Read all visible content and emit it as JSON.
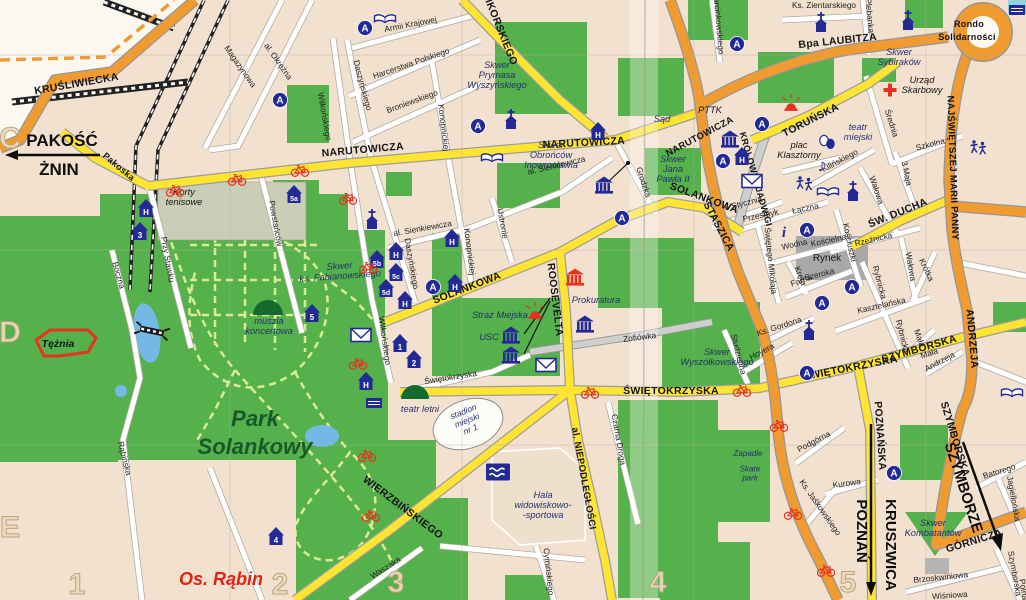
{
  "colors": {
    "background": "#f3e1d0",
    "unmapped": "#fbf9ef",
    "park_green": "#54b14b",
    "dark_green": "#156b2f",
    "road_yellow": "#ffe431",
    "road_orange": "#ef9b30",
    "road_white": "#ffffff",
    "water_blue": "#74b9e6",
    "icon_blue": "#232a96",
    "icon_red": "#e8321e",
    "rynek_gray": "#a8a8a8"
  },
  "grid": {
    "row_labels": [
      {
        "text": "C",
        "x": 10,
        "y": 148
      },
      {
        "text": "D",
        "x": 10,
        "y": 342
      },
      {
        "text": "E",
        "x": 10,
        "y": 537
      }
    ],
    "col_labels": [
      {
        "text": "1",
        "x": 77,
        "y": 594
      },
      {
        "text": "2",
        "x": 280,
        "y": 594
      },
      {
        "text": "3",
        "x": 396,
        "y": 592
      },
      {
        "text": "4",
        "x": 658,
        "y": 592
      },
      {
        "text": "5",
        "x": 848,
        "y": 592
      }
    ]
  },
  "destinations": [
    {
      "lines": [
        "PAKOŚĆ"
      ],
      "x": 62,
      "y": 146,
      "size": 17
    },
    {
      "lines": [
        "ŻNIN"
      ],
      "x": 59,
      "y": 175,
      "size": 17
    },
    {
      "lines": [
        "POZNAŃ"
      ],
      "x": 857,
      "y": 531,
      "rot": 90,
      "size": 15
    },
    {
      "lines": [
        "KRUSZWICA"
      ],
      "x": 886,
      "y": 545,
      "rot": 90,
      "size": 15
    },
    {
      "lines": [
        "SZYMBORZE"
      ],
      "x": 959,
      "y": 489,
      "rot": 72,
      "size": 15
    }
  ],
  "road_labels": [
    {
      "text": "KRUŚLIWIECKA",
      "x": 77,
      "y": 87,
      "rot": -10
    },
    {
      "text": "Bpa LAUBITZA",
      "x": 838,
      "y": 44,
      "rot": -6
    },
    {
      "text": "Rondo",
      "x": 969,
      "y": 27,
      "size": 9
    },
    {
      "text": "Solidarności",
      "x": 967,
      "y": 40,
      "size": 9
    },
    {
      "text": "NAJŚWIĘTSZEJ MARII PANNY",
      "x": 950,
      "y": 168,
      "rot": 88,
      "size": 9.5
    },
    {
      "text": "STASZICA",
      "x": 716,
      "y": 228,
      "rot": 62
    },
    {
      "text": "ANDRZEJA",
      "x": 969,
      "y": 339,
      "rot": 85
    },
    {
      "text": "SZYMBORSKA",
      "x": 952,
      "y": 440,
      "rot": 73
    },
    {
      "text": "GÓRNICZA",
      "x": 975,
      "y": 544,
      "rot": -17
    },
    {
      "text": "KRÓLOWEJ JADWIGI",
      "x": 753,
      "y": 180,
      "rot": 74,
      "size": 9
    },
    {
      "text": "NARUTOWICZA",
      "x": 363,
      "y": 153,
      "rot": -5
    },
    {
      "text": "NARUTOWICZA",
      "x": 584,
      "y": 146,
      "rot": -3
    },
    {
      "text": "NARUTOWICZA",
      "x": 701,
      "y": 139,
      "rot": -28,
      "size": 9.5
    },
    {
      "text": "SIKORSKIEGO",
      "x": 497,
      "y": 30,
      "rot": 68
    },
    {
      "text": "SOLANKOWA",
      "x": 468,
      "y": 291,
      "rot": -21
    },
    {
      "text": "SOLANKOWA",
      "x": 703,
      "y": 201,
      "rot": 20
    },
    {
      "text": "ROOSEVELTA",
      "x": 552,
      "y": 300,
      "rot": 83
    },
    {
      "text": "al. NIEPODLEGŁOŚCI",
      "x": 581,
      "y": 479,
      "rot": 80,
      "size": 9.5
    },
    {
      "text": "ŚWIĘTOKRZYSKA",
      "x": 671,
      "y": 394,
      "rot": 0
    },
    {
      "text": "ŚWIĘTOKRZYSKA",
      "x": 851,
      "y": 371,
      "rot": -11
    },
    {
      "text": "SZYMBORSKA",
      "x": 920,
      "y": 352,
      "rot": -16
    },
    {
      "text": "ŚW. DUCHA",
      "x": 899,
      "y": 216,
      "rot": -22
    },
    {
      "text": "TORUŃSKA",
      "x": 812,
      "y": 123,
      "rot": -27
    },
    {
      "text": "WIERZBIŃSKIEGO",
      "x": 401,
      "y": 510,
      "rot": 37
    },
    {
      "text": "POZNAŃSKA",
      "x": 877,
      "y": 436,
      "rot": 86
    },
    {
      "text": "Pakoska",
      "x": 117,
      "y": 169,
      "rot": 40,
      "size": 9
    }
  ],
  "street_labels": [
    {
      "text": "Magazynowa",
      "x": 238,
      "y": 68,
      "rot": 55
    },
    {
      "text": "al. Okrężna",
      "x": 276,
      "y": 63,
      "rot": 55
    },
    {
      "text": "Wilkońskiego",
      "x": 322,
      "y": 117,
      "rot": 80
    },
    {
      "text": "Wilkońskiego",
      "x": 382,
      "y": 341,
      "rot": 82
    },
    {
      "text": "Armii Krajowej",
      "x": 411,
      "y": 27,
      "rot": -11
    },
    {
      "text": "Harcerstwa Polskiego",
      "x": 412,
      "y": 66,
      "rot": -19
    },
    {
      "text": "Broniewskiego",
      "x": 413,
      "y": 104,
      "rot": -20
    },
    {
      "text": "Daszyńskiego",
      "x": 360,
      "y": 86,
      "rot": 75
    },
    {
      "text": "Daszyńskiego",
      "x": 409,
      "y": 264,
      "rot": 80
    },
    {
      "text": "Konopnickiej",
      "x": 441,
      "y": 128,
      "rot": 83
    },
    {
      "text": "Konopnickiej",
      "x": 467,
      "y": 252,
      "rot": 83
    },
    {
      "text": "Ks. Zientarskiego",
      "x": 824,
      "y": 8,
      "rot": 0
    },
    {
      "text": "Plebanka",
      "x": 867,
      "y": 16,
      "rot": 85
    },
    {
      "text": "Marcinkowskiego",
      "x": 716,
      "y": 23,
      "rot": 85
    },
    {
      "text": "Średnia",
      "x": 889,
      "y": 124,
      "rot": 72
    },
    {
      "text": "Szkolna",
      "x": 931,
      "y": 147,
      "rot": -14
    },
    {
      "text": "3 Maja",
      "x": 904,
      "y": 174,
      "rot": 78
    },
    {
      "text": "Kilińskiego",
      "x": 841,
      "y": 163,
      "rot": -28
    },
    {
      "text": "Wałowa",
      "x": 874,
      "y": 191,
      "rot": 72
    },
    {
      "text": "Wałowa",
      "x": 908,
      "y": 267,
      "rot": 80
    },
    {
      "text": "Krótka",
      "x": 924,
      "y": 271,
      "rot": 65
    },
    {
      "text": "Rzeźnicka",
      "x": 874,
      "y": 242,
      "rot": -13
    },
    {
      "text": "Kościelna",
      "x": 829,
      "y": 243,
      "rot": -12
    },
    {
      "text": "Wodna",
      "x": 795,
      "y": 247,
      "rot": -12
    },
    {
      "text": "Kościuszki",
      "x": 847,
      "y": 243,
      "rot": 78
    },
    {
      "text": "Szeroka",
      "x": 820,
      "y": 277,
      "rot": -14
    },
    {
      "text": "Farna",
      "x": 802,
      "y": 283,
      "rot": -20
    },
    {
      "text": "Rybnicka",
      "x": 877,
      "y": 283,
      "rot": 75
    },
    {
      "text": "Rybnicka",
      "x": 900,
      "y": 337,
      "rot": 75
    },
    {
      "text": "Świętego Mikołaja",
      "x": 768,
      "y": 261,
      "rot": 84
    },
    {
      "text": "Kręta",
      "x": 798,
      "y": 277,
      "rot": 68
    },
    {
      "text": "Przesmyk",
      "x": 761,
      "y": 218,
      "rot": -12
    },
    {
      "text": "Łączna",
      "x": 806,
      "y": 211,
      "rot": -12
    },
    {
      "text": "6 Stycznia",
      "x": 744,
      "y": 206,
      "rot": -14
    },
    {
      "text": "Kasztelańska",
      "x": 882,
      "y": 308,
      "rot": -13
    },
    {
      "text": "Mała",
      "x": 917,
      "y": 339,
      "rot": 70
    },
    {
      "text": "Mała",
      "x": 930,
      "y": 356,
      "rot": -18
    },
    {
      "text": "Andrzeja",
      "x": 941,
      "y": 364,
      "rot": -28
    },
    {
      "text": "Ks. Gordona",
      "x": 780,
      "y": 329,
      "rot": -18
    },
    {
      "text": "Hoyera",
      "x": 763,
      "y": 354,
      "rot": -28
    },
    {
      "text": "Studzienna",
      "x": 736,
      "y": 355,
      "rot": 76
    },
    {
      "text": "Zofiówka",
      "x": 640,
      "y": 340,
      "rot": -7
    },
    {
      "text": "Podgórna",
      "x": 815,
      "y": 444,
      "rot": -28
    },
    {
      "text": "Kurowa",
      "x": 847,
      "y": 486,
      "rot": -8
    },
    {
      "text": "Ks. Jaśkowskiego",
      "x": 818,
      "y": 509,
      "rot": 55
    },
    {
      "text": "Batorego",
      "x": 1000,
      "y": 474,
      "rot": -17
    },
    {
      "text": "Jagiellońska",
      "x": 1011,
      "y": 499,
      "rot": 80
    },
    {
      "text": "Szymborska",
      "x": 1012,
      "y": 574,
      "rot": 80
    },
    {
      "text": "Polna",
      "x": 1021,
      "y": 590,
      "rot": 80
    },
    {
      "text": "Brzoskwiniowa",
      "x": 941,
      "y": 580,
      "rot": -6
    },
    {
      "text": "Wiśniowa",
      "x": 950,
      "y": 598,
      "rot": -4
    },
    {
      "text": "Czarna Droga",
      "x": 616,
      "y": 440,
      "rot": 80
    },
    {
      "text": "Cymińskiego",
      "x": 546,
      "y": 572,
      "rot": 84
    },
    {
      "text": "Waszaka",
      "x": 387,
      "y": 570,
      "rot": -33
    },
    {
      "text": "Rąbińska",
      "x": 122,
      "y": 459,
      "rot": 76
    },
    {
      "text": "Boczna",
      "x": 116,
      "y": 276,
      "rot": 74
    },
    {
      "text": "Przy Stawku",
      "x": 165,
      "y": 260,
      "rot": 80
    },
    {
      "text": "Powstańców",
      "x": 273,
      "y": 224,
      "rot": 80
    },
    {
      "text": "Ustronie",
      "x": 500,
      "y": 224,
      "rot": 80
    },
    {
      "text": "al. Sienkiewicza",
      "x": 557,
      "y": 168,
      "rot": -13
    },
    {
      "text": "al. Sienkiewicza",
      "x": 423,
      "y": 231,
      "rot": -10
    },
    {
      "text": "Grodzka",
      "x": 641,
      "y": 183,
      "rot": 72
    },
    {
      "text": "Świętokrzyska",
      "x": 451,
      "y": 380,
      "rot": -9
    }
  ],
  "place_labels": [
    {
      "lines": [
        "Skwer",
        "Prymasa",
        "Wyszyńskiego"
      ],
      "x": 497,
      "y": 78
    },
    {
      "lines": [
        "Sąd"
      ],
      "x": 662,
      "y": 122
    },
    {
      "lines": [
        "Skwer",
        "Obrońców",
        "Inowrocławia"
      ],
      "x": 551,
      "y": 158
    },
    {
      "lines": [
        "Skwer",
        "Jana",
        "Pawła II"
      ],
      "x": 673,
      "y": 172
    },
    {
      "lines": [
        "Skwer",
        "Sybiraków"
      ],
      "x": 899,
      "y": 60
    },
    {
      "lines": [
        "Urząd",
        "Skarbowy"
      ],
      "x": 922,
      "y": 88,
      "cls": "lbl-place-black"
    },
    {
      "lines": [
        "PTTK"
      ],
      "x": 710,
      "y": 113,
      "cls": "lbl-place-black"
    },
    {
      "lines": [
        "teatr",
        "miejski"
      ],
      "x": 858,
      "y": 135
    },
    {
      "lines": [
        "plac",
        "Klasztorny"
      ],
      "x": 799,
      "y": 153,
      "cls": "lbl-place-black"
    },
    {
      "lines": [
        "Rynek"
      ],
      "x": 827,
      "y": 261,
      "cls": "lbl-rynek"
    },
    {
      "lines": [
        "Korty",
        "tenisowe"
      ],
      "x": 184,
      "y": 200,
      "cls": "lbl-place-black"
    },
    {
      "lines": [
        "Skwer",
        "ks. Fabianowskiego"
      ],
      "x": 340,
      "y": 274,
      "rot": -4
    },
    {
      "lines": [
        "muszla",
        "koncertowa"
      ],
      "x": 269,
      "y": 329
    },
    {
      "lines": [
        "Tężnia"
      ],
      "x": 58,
      "y": 347,
      "cls": "lbl-place-bold-black"
    },
    {
      "lines": [
        "Park",
        "Solankowy"
      ],
      "x": 255,
      "y": 440,
      "cls": "lbl-park",
      "lh": 28
    },
    {
      "lines": [
        "Os. Rąbin"
      ],
      "x": 221,
      "y": 585,
      "cls": "lbl-district"
    },
    {
      "lines": [
        "teatr letni"
      ],
      "x": 420,
      "y": 412
    },
    {
      "lines": [
        "stadion",
        "miejski",
        "nr 1"
      ],
      "x": 468,
      "y": 423,
      "rot": -22,
      "size": 8.5
    },
    {
      "lines": [
        "Hala",
        "widowiskowo-",
        "-sportowa"
      ],
      "x": 543,
      "y": 508
    },
    {
      "lines": [
        "Straż Miejska"
      ],
      "x": 500,
      "y": 318
    },
    {
      "lines": [
        "USC"
      ],
      "x": 489,
      "y": 340
    },
    {
      "lines": [
        "Prokuratura"
      ],
      "x": 596,
      "y": 303
    },
    {
      "lines": [
        "Skwer",
        "Wyszółkowskiego"
      ],
      "x": 717,
      "y": 360
    },
    {
      "lines": [
        "Skwer",
        "Kombatantów"
      ],
      "x": 933,
      "y": 531
    },
    {
      "lines": [
        "Zapadle"
      ],
      "x": 748,
      "y": 456,
      "size": 8
    },
    {
      "lines": [
        "Skate",
        "park"
      ],
      "x": 750,
      "y": 476,
      "size": 8,
      "lh": 9
    }
  ],
  "icons": [
    {
      "type": "bus-stop",
      "x": 280,
      "y": 100,
      "label": "A"
    },
    {
      "type": "bus-stop",
      "x": 365,
      "y": 28,
      "label": "A"
    },
    {
      "type": "bus-stop",
      "x": 478,
      "y": 126,
      "label": "A"
    },
    {
      "type": "bus-stop",
      "x": 737,
      "y": 44,
      "label": "A"
    },
    {
      "type": "bus-stop",
      "x": 762,
      "y": 124,
      "label": "A"
    },
    {
      "type": "bus-stop",
      "x": 723,
      "y": 161,
      "label": "A"
    },
    {
      "type": "bus-stop",
      "x": 622,
      "y": 218,
      "label": "A"
    },
    {
      "type": "bus-stop",
      "x": 433,
      "y": 287,
      "label": "A"
    },
    {
      "type": "bus-stop",
      "x": 807,
      "y": 230,
      "label": "A"
    },
    {
      "type": "bus-stop",
      "x": 852,
      "y": 287,
      "label": "A"
    },
    {
      "type": "bus-stop",
      "x": 822,
      "y": 303,
      "label": "A"
    },
    {
      "type": "bus-stop",
      "x": 807,
      "y": 373,
      "label": "A"
    },
    {
      "type": "bus-stop",
      "x": 894,
      "y": 473,
      "label": "A"
    },
    {
      "type": "house",
      "x": 146,
      "y": 208,
      "label": "H"
    },
    {
      "type": "house",
      "x": 598,
      "y": 131,
      "label": "H"
    },
    {
      "type": "house",
      "x": 742,
      "y": 156,
      "label": "H"
    },
    {
      "type": "house",
      "x": 396,
      "y": 251,
      "label": "H"
    },
    {
      "type": "house",
      "x": 452,
      "y": 238,
      "label": "H"
    },
    {
      "type": "house",
      "x": 455,
      "y": 283,
      "label": "H"
    },
    {
      "type": "house",
      "x": 405,
      "y": 300,
      "label": "H"
    },
    {
      "type": "house",
      "x": 366,
      "y": 381,
      "label": "H"
    },
    {
      "type": "house",
      "x": 140,
      "y": 231,
      "label": "3"
    },
    {
      "type": "house",
      "x": 294,
      "y": 194,
      "label": "5a"
    },
    {
      "type": "house",
      "x": 377,
      "y": 259,
      "label": "5b"
    },
    {
      "type": "house",
      "x": 396,
      "y": 272,
      "label": "5c"
    },
    {
      "type": "house",
      "x": 386,
      "y": 288,
      "label": "5d"
    },
    {
      "type": "house",
      "x": 312,
      "y": 313,
      "label": "5"
    },
    {
      "type": "house",
      "x": 400,
      "y": 343,
      "label": "1"
    },
    {
      "type": "house",
      "x": 414,
      "y": 359,
      "label": "2"
    },
    {
      "type": "house",
      "x": 276,
      "y": 536,
      "label": "4"
    },
    {
      "type": "church",
      "x": 511,
      "y": 122
    },
    {
      "type": "church",
      "x": 372,
      "y": 222
    },
    {
      "type": "church",
      "x": 853,
      "y": 194
    },
    {
      "type": "church",
      "x": 821,
      "y": 25
    },
    {
      "type": "church",
      "x": 908,
      "y": 23
    },
    {
      "type": "church",
      "x": 809,
      "y": 333
    },
    {
      "type": "book",
      "x": 385,
      "y": 19
    },
    {
      "type": "book",
      "x": 492,
      "y": 158
    },
    {
      "type": "book",
      "x": 828,
      "y": 192
    },
    {
      "type": "book",
      "x": 1012,
      "y": 393
    },
    {
      "type": "envelope",
      "x": 361,
      "y": 335
    },
    {
      "type": "envelope",
      "x": 546,
      "y": 365
    },
    {
      "type": "envelope",
      "x": 752,
      "y": 181
    },
    {
      "type": "museum",
      "x": 730,
      "y": 140
    },
    {
      "type": "museum",
      "x": 604,
      "y": 186
    },
    {
      "type": "museum",
      "x": 511,
      "y": 336
    },
    {
      "type": "museum",
      "x": 511,
      "y": 356
    },
    {
      "type": "museum",
      "x": 585,
      "y": 325
    },
    {
      "type": "museum-red",
      "x": 575,
      "y": 278
    },
    {
      "type": "siren",
      "x": 535,
      "y": 313
    },
    {
      "type": "siren",
      "x": 791,
      "y": 105
    },
    {
      "type": "red-cross",
      "x": 890,
      "y": 90
    },
    {
      "type": "swimming",
      "x": 498,
      "y": 472
    },
    {
      "type": "theater-masks",
      "x": 827,
      "y": 142
    },
    {
      "type": "building",
      "x": 374,
      "y": 403
    },
    {
      "type": "building",
      "x": 1017,
      "y": 10
    },
    {
      "type": "music-note",
      "x": 822,
      "y": 166
    },
    {
      "type": "info",
      "x": 784,
      "y": 232
    },
    {
      "type": "dancers",
      "x": 804,
      "y": 184
    },
    {
      "type": "dancers",
      "x": 978,
      "y": 148
    },
    {
      "type": "bridge",
      "x": 152,
      "y": 331,
      "rot": 12
    },
    {
      "type": "bicycle",
      "x": 175,
      "y": 190
    },
    {
      "type": "bicycle",
      "x": 237,
      "y": 179
    },
    {
      "type": "bicycle",
      "x": 300,
      "y": 170
    },
    {
      "type": "bicycle",
      "x": 348,
      "y": 198
    },
    {
      "type": "bicycle",
      "x": 368,
      "y": 267
    },
    {
      "type": "bicycle",
      "x": 358,
      "y": 363
    },
    {
      "type": "bicycle",
      "x": 367,
      "y": 455
    },
    {
      "type": "bicycle",
      "x": 371,
      "y": 515
    },
    {
      "type": "bicycle",
      "x": 590,
      "y": 392
    },
    {
      "type": "bicycle",
      "x": 742,
      "y": 390
    },
    {
      "type": "bicycle",
      "x": 779,
      "y": 425
    },
    {
      "type": "bicycle",
      "x": 793,
      "y": 513
    },
    {
      "type": "bicycle",
      "x": 826,
      "y": 570
    }
  ]
}
